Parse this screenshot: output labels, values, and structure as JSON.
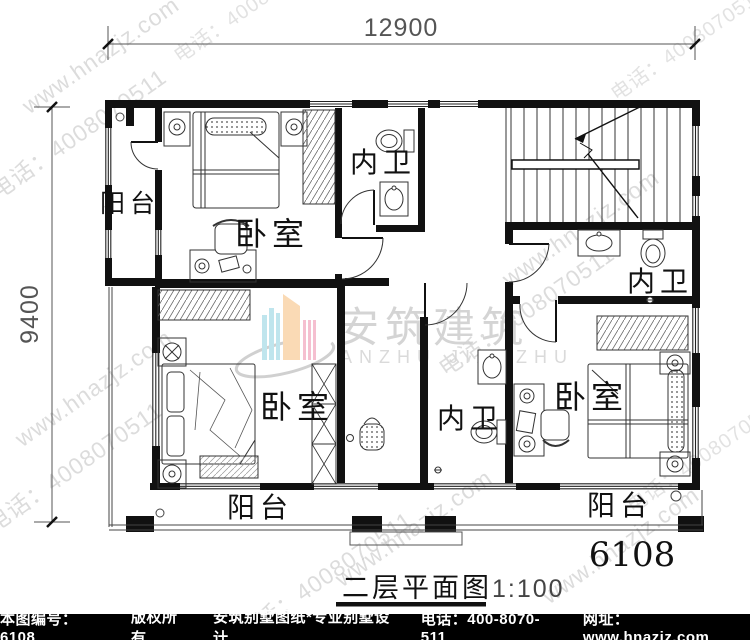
{
  "dimensions": {
    "top": "12900",
    "left": "9400"
  },
  "rooms": {
    "balcony_west": "阳台",
    "bedroom_nw": "卧室",
    "bath_north": "内卫",
    "bath_east": "内卫",
    "bedroom_sw": "卧室",
    "bath_south": "内卫",
    "bedroom_se": "卧室",
    "balcony_south_left": "阳台",
    "balcony_south_right": "阳台"
  },
  "plan": {
    "number": "6108",
    "caption_title": "二层平面图",
    "caption_scale": "1:100"
  },
  "watermark": {
    "website": "www.hnazjz.com",
    "phone": "电话：4008070511",
    "logo_cn": "安筑建筑",
    "logo_en": "ANZHU JIANZHU"
  },
  "footer": {
    "code": "本图编号：6108",
    "rights": "版权所有",
    "brand": "安筑别墅图纸*专业别墅设计",
    "phone": "电话：400-8070-511",
    "site": "网址：www.hnazjz.com"
  },
  "colors": {
    "line": "#111111",
    "dim": "#555555",
    "watermark": "#c0c0c0",
    "footer_bg": "#000000",
    "logo_cyan": "#b9e3ec",
    "logo_peach": "#fad7ae",
    "logo_pink": "#f5b9cc"
  }
}
